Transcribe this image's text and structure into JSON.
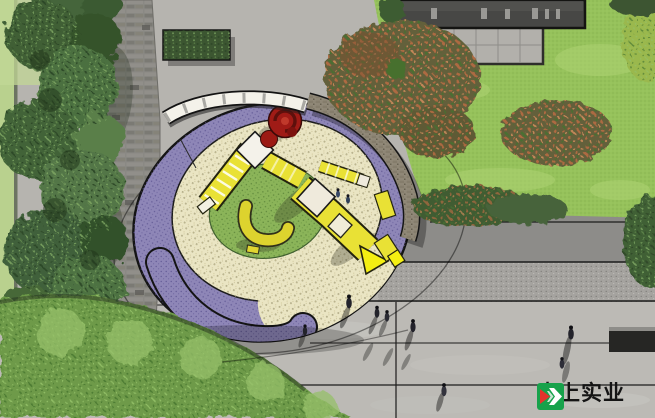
{
  "scene": {
    "description": "Top-down landscape site plan rendering of an oval children's playground plaza",
    "regions": [
      "left-tree-canopy",
      "brick-path",
      "top-plaza-paving",
      "hedge-planter",
      "building-roof",
      "paved-terrace",
      "lawn",
      "autumn-bushes",
      "playground-oval",
      "purple-safety-surface",
      "sand-surface",
      "green-play-circle",
      "yellow-play-structure",
      "spiral-slide",
      "white-bench-arc",
      "stone-seat-wall",
      "bottom-shrub-mass",
      "paving-bands",
      "pedestrians",
      "bench-block"
    ],
    "people_count": 10
  },
  "watermark": {
    "text": "大上实业"
  },
  "palette": {
    "plaza": "#b6b4af",
    "plaza_bottom": "#bcbab5",
    "band_dark": "#8d8c89",
    "band_granite": "#a5a39f",
    "path_brick": "#8a8984",
    "roof": "#474745",
    "terrace": "#b2b0ab",
    "lawn": "#96c25b",
    "tree_green": "#47683c",
    "shrub_green": "#6e9a49",
    "bush_red": "#64603a",
    "purple": "#8e86b7",
    "cream": "#eae5c3",
    "play_green": "#8bb459",
    "play_yellow": "#e9e135",
    "slide_tip_yellow": "#f4ef12",
    "stone": "#8f8777",
    "white_bench": "#f4f2ea",
    "spiral_red": "#a01b16",
    "logo_green": "#17a24b",
    "logo_red": "#e4342c"
  }
}
